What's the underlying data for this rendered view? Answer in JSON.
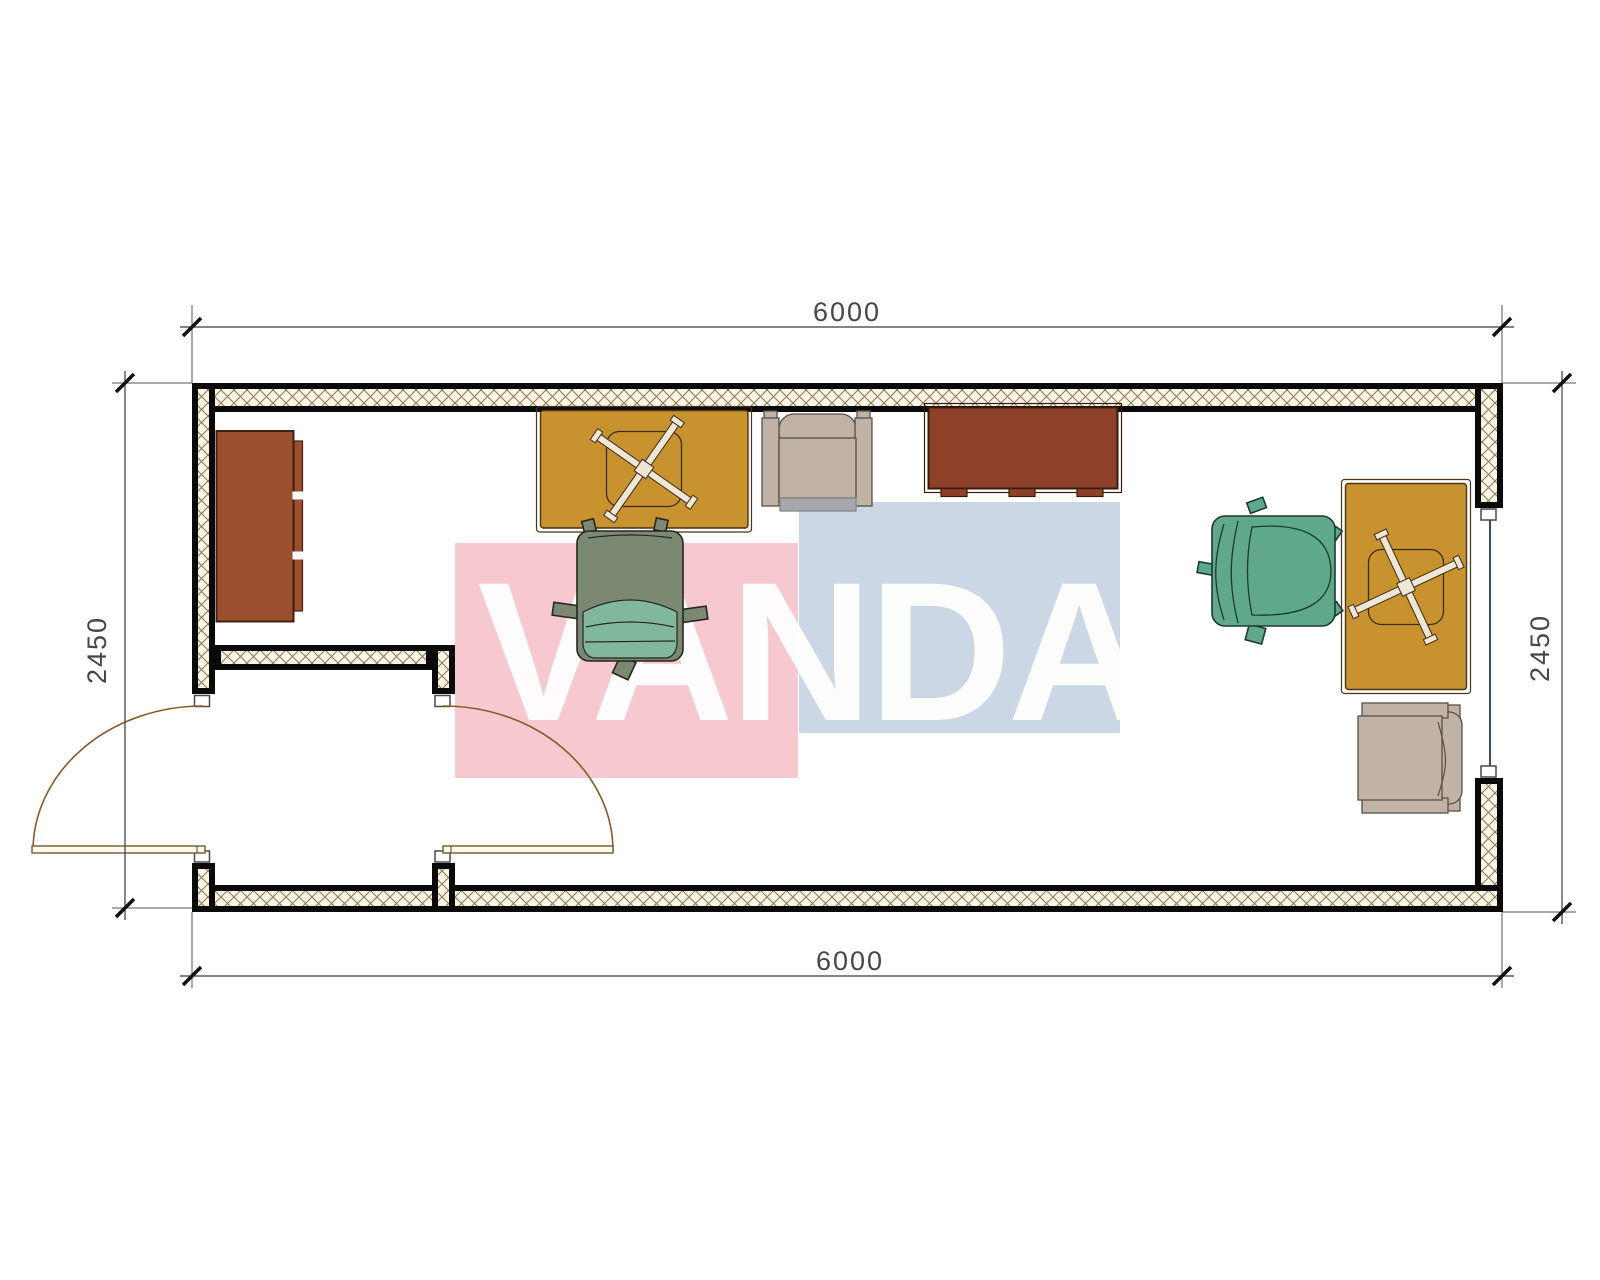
{
  "watermark": {
    "text": "VANDA",
    "pink_panel_color": "#f6c8d0",
    "blue_panel_color": "#ccd7e5",
    "text_color": "#ffffff"
  },
  "dimensions": {
    "top": {
      "label": "6000"
    },
    "bottom": {
      "label": "6000"
    },
    "left": {
      "label": "2450"
    },
    "right": {
      "label": "2450"
    }
  },
  "colors": {
    "wall_hatch_bg": "#faf5e8",
    "wall_hatch_line": "#8d7d55",
    "wall_border": "#0a0a0a",
    "desk": "#c8932e",
    "desk_outline": "#4a3318",
    "cabinet": "#9c4f2e",
    "table": "#8d4129",
    "wood_outline": "#3a1a0e",
    "armchair": "#c0b2a4",
    "armchair_outline": "#57504a",
    "armchair_shadow": "#a5a7ab",
    "chair_teal": "#5fa88b",
    "chair_olive": "#7b8972",
    "chair_cushion": "#81b89c",
    "chair_outline": "#26251f",
    "door_arc": "#8a5a28",
    "door_leaf_fill": "#fcf9ee",
    "door_leaf_stroke": "#6f5b35",
    "window_line": "#3c4a63",
    "dim_line": "#3a3a3a",
    "tick": "#111111",
    "star_base": "#f0e6d4",
    "star_outline": "#3c2a16"
  },
  "furniture": [
    {
      "name": "sideboard-cabinet"
    },
    {
      "name": "desk-left"
    },
    {
      "name": "office-chair-left"
    },
    {
      "name": "armchair-top"
    },
    {
      "name": "meeting-table"
    },
    {
      "name": "office-chair-right"
    },
    {
      "name": "desk-right"
    },
    {
      "name": "armchair-right"
    }
  ]
}
